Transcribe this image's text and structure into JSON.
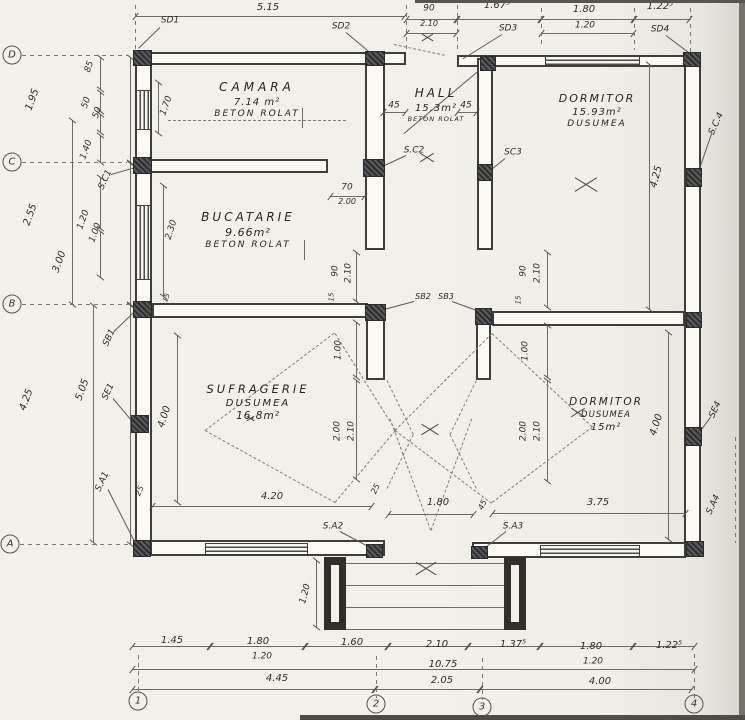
{
  "drawing": {
    "paper_color": "#f1efe9",
    "ink_color": "#3e3e3e",
    "dim_color": "#6e6b66"
  },
  "grid": {
    "rows": [
      {
        "label": "D",
        "x": 12,
        "y": 55
      },
      {
        "label": "C",
        "x": 12,
        "y": 162
      },
      {
        "label": "B",
        "x": 12,
        "y": 304
      },
      {
        "label": "A",
        "x": 10,
        "y": 544
      }
    ],
    "cols": [
      {
        "label": "1",
        "x": 138,
        "y": 701
      },
      {
        "label": "2",
        "x": 376,
        "y": 704
      },
      {
        "label": "3",
        "x": 482,
        "y": 707
      },
      {
        "label": "4",
        "x": 694,
        "y": 704
      }
    ]
  },
  "rooms": [
    {
      "name": "camara",
      "cx": 257,
      "cy": 80,
      "lines": [
        {
          "t": "CAMARA",
          "fs": 12,
          "ls": 4
        },
        {
          "t": "7.14 m²",
          "fs": 10,
          "ls": 1
        },
        {
          "t": "BETON ROLAT",
          "fs": 9,
          "ls": 2
        }
      ]
    },
    {
      "name": "hall",
      "cx": 436,
      "cy": 86,
      "lines": [
        {
          "t": "HALL",
          "fs": 12,
          "ls": 3
        },
        {
          "t": "15.3m²",
          "fs": 10,
          "ls": 1
        },
        {
          "t": "BETON ROLAT",
          "fs": 6.5,
          "ls": 1
        }
      ]
    },
    {
      "name": "dormitor-1",
      "cx": 597,
      "cy": 92,
      "lines": [
        {
          "t": "DORMITOR",
          "fs": 11,
          "ls": 2
        },
        {
          "t": "15.93m²",
          "fs": 10,
          "ls": 1
        },
        {
          "t": "DUSUMEA",
          "fs": 9,
          "ls": 2
        }
      ]
    },
    {
      "name": "bucatarie",
      "cx": 248,
      "cy": 210,
      "lines": [
        {
          "t": "BUCATARIE",
          "fs": 12,
          "ls": 3
        },
        {
          "t": "9.66m²",
          "fs": 11,
          "ls": 1
        },
        {
          "t": "BETON ROLAT",
          "fs": 9,
          "ls": 2
        }
      ]
    },
    {
      "name": "sufragerie",
      "cx": 258,
      "cy": 382,
      "lines": [
        {
          "t": "SUFRAGERIE",
          "fs": 11.5,
          "ls": 3
        },
        {
          "t": "DUSUMEA",
          "fs": 10,
          "ls": 2
        },
        {
          "t": "16.8m²",
          "fs": 10.5,
          "ls": 1
        }
      ]
    },
    {
      "name": "dormitor-2",
      "cx": 606,
      "cy": 396,
      "lines": [
        {
          "t": "DORMITOR",
          "fs": 10.5,
          "ls": 2
        },
        {
          "t": "DUSUMEA",
          "fs": 8.5,
          "ls": 1
        },
        {
          "t": "15m²",
          "fs": 10,
          "ls": 1
        }
      ]
    }
  ],
  "annotations": [
    {
      "n": "dim-5-15",
      "t": "5.15",
      "x": 268,
      "y": 8
    },
    {
      "n": "dim-90-top",
      "t": "90",
      "x": 429,
      "y": 9,
      "fs": 9
    },
    {
      "n": "dim-2-10-top",
      "t": "2.10",
      "x": 429,
      "y": 24,
      "fs": 8
    },
    {
      "n": "dim-1-67-5",
      "t": "1.67⁵",
      "x": 497,
      "y": 6
    },
    {
      "n": "label-sd3",
      "t": "SD3",
      "x": 508,
      "y": 29,
      "fs": 9
    },
    {
      "n": "dim-1-80-top",
      "t": "1.80",
      "x": 584,
      "y": 10
    },
    {
      "n": "dim-1-20-top",
      "t": "1.20",
      "x": 585,
      "y": 26,
      "fs": 9
    },
    {
      "n": "dim-1-22-5-top",
      "t": "1.22⁵",
      "x": 660,
      "y": 7
    },
    {
      "n": "label-sd4",
      "t": "SD4",
      "x": 660,
      "y": 30,
      "fs": 9
    },
    {
      "n": "label-sd1",
      "t": "SD1",
      "x": 170,
      "y": 21,
      "fs": 9
    },
    {
      "n": "label-sd2",
      "t": "SD2",
      "x": 341,
      "y": 27,
      "fs": 9
    },
    {
      "n": "dim-1-95",
      "t": "1.95",
      "x": 33,
      "y": 100,
      "r": -70
    },
    {
      "n": "dim-2-55",
      "t": "2.55",
      "x": 31,
      "y": 215,
      "r": -70
    },
    {
      "n": "dim-4-25-left",
      "t": "4.25",
      "x": 27,
      "y": 400,
      "r": -70
    },
    {
      "n": "dim-3-00",
      "t": "3.00",
      "x": 60,
      "y": 262,
      "r": -70
    },
    {
      "n": "dim-5-05",
      "t": "5.05",
      "x": 83,
      "y": 390,
      "r": -70
    },
    {
      "n": "dim-85",
      "t": "85",
      "x": 90,
      "y": 67,
      "r": -70,
      "fs": 9
    },
    {
      "n": "dim-50-a",
      "t": "50",
      "x": 87,
      "y": 103,
      "r": -70,
      "fs": 9
    },
    {
      "n": "dim-50-b",
      "t": "50",
      "x": 98,
      "y": 113,
      "r": -70,
      "fs": 9
    },
    {
      "n": "dim-1-40",
      "t": "1.40",
      "x": 87,
      "y": 150,
      "r": -70,
      "fs": 9
    },
    {
      "n": "dim-1-20-left",
      "t": "1.20",
      "x": 84,
      "y": 220,
      "r": -70,
      "fs": 9
    },
    {
      "n": "dim-1-00-left",
      "t": "1.00",
      "x": 96,
      "y": 233,
      "r": -70,
      "fs": 9
    },
    {
      "n": "label-sc1",
      "t": "S.C1",
      "x": 106,
      "y": 180,
      "r": -65,
      "fs": 9
    },
    {
      "n": "label-sb1",
      "t": "SB1",
      "x": 110,
      "y": 338,
      "r": -65,
      "fs": 9
    },
    {
      "n": "label-se1",
      "t": "SE1",
      "x": 109,
      "y": 392,
      "r": -65,
      "fs": 9
    },
    {
      "n": "label-sa1",
      "t": "S.A1",
      "x": 103,
      "y": 482,
      "r": -65,
      "fs": 9
    },
    {
      "n": "dim-1-70",
      "t": "1.70",
      "x": 167,
      "y": 106,
      "r": -70,
      "fs": 9
    },
    {
      "n": "dim-45-left",
      "t": "45",
      "x": 394,
      "y": 106,
      "fs": 9
    },
    {
      "n": "dim-45-right",
      "t": "45",
      "x": 466,
      "y": 106,
      "fs": 9
    },
    {
      "n": "dim-4-25-dorm",
      "t": "4.25",
      "x": 657,
      "y": 177,
      "r": -75
    },
    {
      "n": "label-sc4",
      "t": "S.C.4",
      "x": 717,
      "y": 124,
      "r": -65,
      "fs": 9
    },
    {
      "n": "dim-2-30",
      "t": "2.30",
      "x": 172,
      "y": 230,
      "r": -72,
      "fs": 9
    },
    {
      "n": "dim-70",
      "t": "70",
      "x": 347,
      "y": 188,
      "fs": 9
    },
    {
      "n": "dim-2-00-buc",
      "t": "2.00",
      "x": 347,
      "y": 202,
      "fs": 8
    },
    {
      "n": "label-sc2",
      "t": "S.C2",
      "x": 414,
      "y": 151,
      "fs": 9
    },
    {
      "n": "label-sc3",
      "t": "SC3",
      "x": 513,
      "y": 153,
      "fs": 9
    },
    {
      "n": "dim-15-bwall",
      "t": "15",
      "x": 167,
      "y": 298,
      "r": -70,
      "fs": 7
    },
    {
      "n": "dim-90-hall-l",
      "t": "90",
      "x": 336,
      "y": 271,
      "r": -90,
      "fs": 9
    },
    {
      "n": "dim-2-10-hall-l",
      "t": "2.10",
      "x": 349,
      "y": 273,
      "r": -90,
      "fs": 9
    },
    {
      "n": "dim-90-hall-r",
      "t": "90",
      "x": 524,
      "y": 271,
      "r": -90,
      "fs": 9
    },
    {
      "n": "dim-2-10-hall-r",
      "t": "2.10",
      "x": 538,
      "y": 273,
      "r": -90,
      "fs": 9
    },
    {
      "n": "dim-15-l",
      "t": "15",
      "x": 332,
      "y": 297,
      "r": -90,
      "fs": 7
    },
    {
      "n": "dim-15-r",
      "t": "15",
      "x": 519,
      "y": 300,
      "r": -90,
      "fs": 7
    },
    {
      "n": "label-sb2",
      "t": "SB2",
      "x": 423,
      "y": 297,
      "fs": 8
    },
    {
      "n": "label-sb3",
      "t": "SB3",
      "x": 446,
      "y": 297,
      "fs": 8
    },
    {
      "n": "dim-1-00-hall-l",
      "t": "1.00",
      "x": 339,
      "y": 350,
      "r": -90,
      "fs": 9
    },
    {
      "n": "dim-1-00-hall-r",
      "t": "1.00",
      "x": 526,
      "y": 351,
      "r": -90,
      "fs": 9
    },
    {
      "n": "dim-2-00-suf",
      "t": "2.00",
      "x": 338,
      "y": 431,
      "r": -90,
      "fs": 9
    },
    {
      "n": "dim-2-10-suf",
      "t": "2.10",
      "x": 352,
      "y": 431,
      "r": -90,
      "fs": 9
    },
    {
      "n": "dim-2-00-dorm",
      "t": "2.00",
      "x": 524,
      "y": 431,
      "r": -90,
      "fs": 9
    },
    {
      "n": "dim-2-10-dorm",
      "t": "2.10",
      "x": 538,
      "y": 431,
      "r": -90,
      "fs": 9
    },
    {
      "n": "dim-4-00-suf",
      "t": "4.00",
      "x": 165,
      "y": 417,
      "r": -72
    },
    {
      "n": "dim-4-20",
      "t": "4.20",
      "x": 272,
      "y": 497
    },
    {
      "n": "dim-25-a",
      "t": "25",
      "x": 140,
      "y": 491,
      "r": -65,
      "fs": 8
    },
    {
      "n": "dim-25-b",
      "t": "25",
      "x": 376,
      "y": 489,
      "r": -65,
      "fs": 8
    },
    {
      "n": "dim-1-80-door",
      "t": "1.80",
      "x": 438,
      "y": 503
    },
    {
      "n": "dim-45-a3",
      "t": "45",
      "x": 483,
      "y": 505,
      "r": -65,
      "fs": 8
    },
    {
      "n": "dim-3-75",
      "t": "3.75",
      "x": 598,
      "y": 503
    },
    {
      "n": "dim-4-00-dorm",
      "t": "4.00",
      "x": 657,
      "y": 425,
      "r": -72
    },
    {
      "n": "label-se4",
      "t": "SE4",
      "x": 716,
      "y": 410,
      "r": -65,
      "fs": 9
    },
    {
      "n": "label-sa4",
      "t": "S.A4",
      "x": 714,
      "y": 505,
      "r": -65,
      "fs": 9
    },
    {
      "n": "label-sa2",
      "t": "S.A2",
      "x": 333,
      "y": 527,
      "fs": 9
    },
    {
      "n": "label-sa3",
      "t": "S.A3",
      "x": 513,
      "y": 527,
      "fs": 9
    },
    {
      "n": "dim-1-20-porch",
      "t": "1.20",
      "x": 306,
      "y": 594,
      "r": -75,
      "fs": 9
    },
    {
      "n": "dim-1-45",
      "t": "1.45",
      "x": 172,
      "y": 641
    },
    {
      "n": "dim-1-80-b1",
      "t": "1.80",
      "x": 258,
      "y": 642
    },
    {
      "n": "dim-1-20-b1",
      "t": "1.20",
      "x": 262,
      "y": 657,
      "fs": 9
    },
    {
      "n": "dim-1-60",
      "t": "1.60",
      "x": 352,
      "y": 643
    },
    {
      "n": "dim-2-10-b",
      "t": "2.10",
      "x": 437,
      "y": 645
    },
    {
      "n": "dim-1-37-5",
      "t": "1.37⁵",
      "x": 513,
      "y": 645
    },
    {
      "n": "dim-1-80-b2",
      "t": "1.80",
      "x": 591,
      "y": 647
    },
    {
      "n": "dim-1-20-b2",
      "t": "1.20",
      "x": 593,
      "y": 662,
      "fs": 9
    },
    {
      "n": "dim-1-22-5-b",
      "t": "1.22⁵",
      "x": 669,
      "y": 646
    },
    {
      "n": "dim-10-75",
      "t": "10.75",
      "x": 443,
      "y": 665
    },
    {
      "n": "dim-4-45",
      "t": "4.45",
      "x": 277,
      "y": 679
    },
    {
      "n": "dim-2-05",
      "t": "2.05",
      "x": 442,
      "y": 681
    },
    {
      "n": "dim-4-00-b",
      "t": "4.00",
      "x": 600,
      "y": 682
    }
  ]
}
